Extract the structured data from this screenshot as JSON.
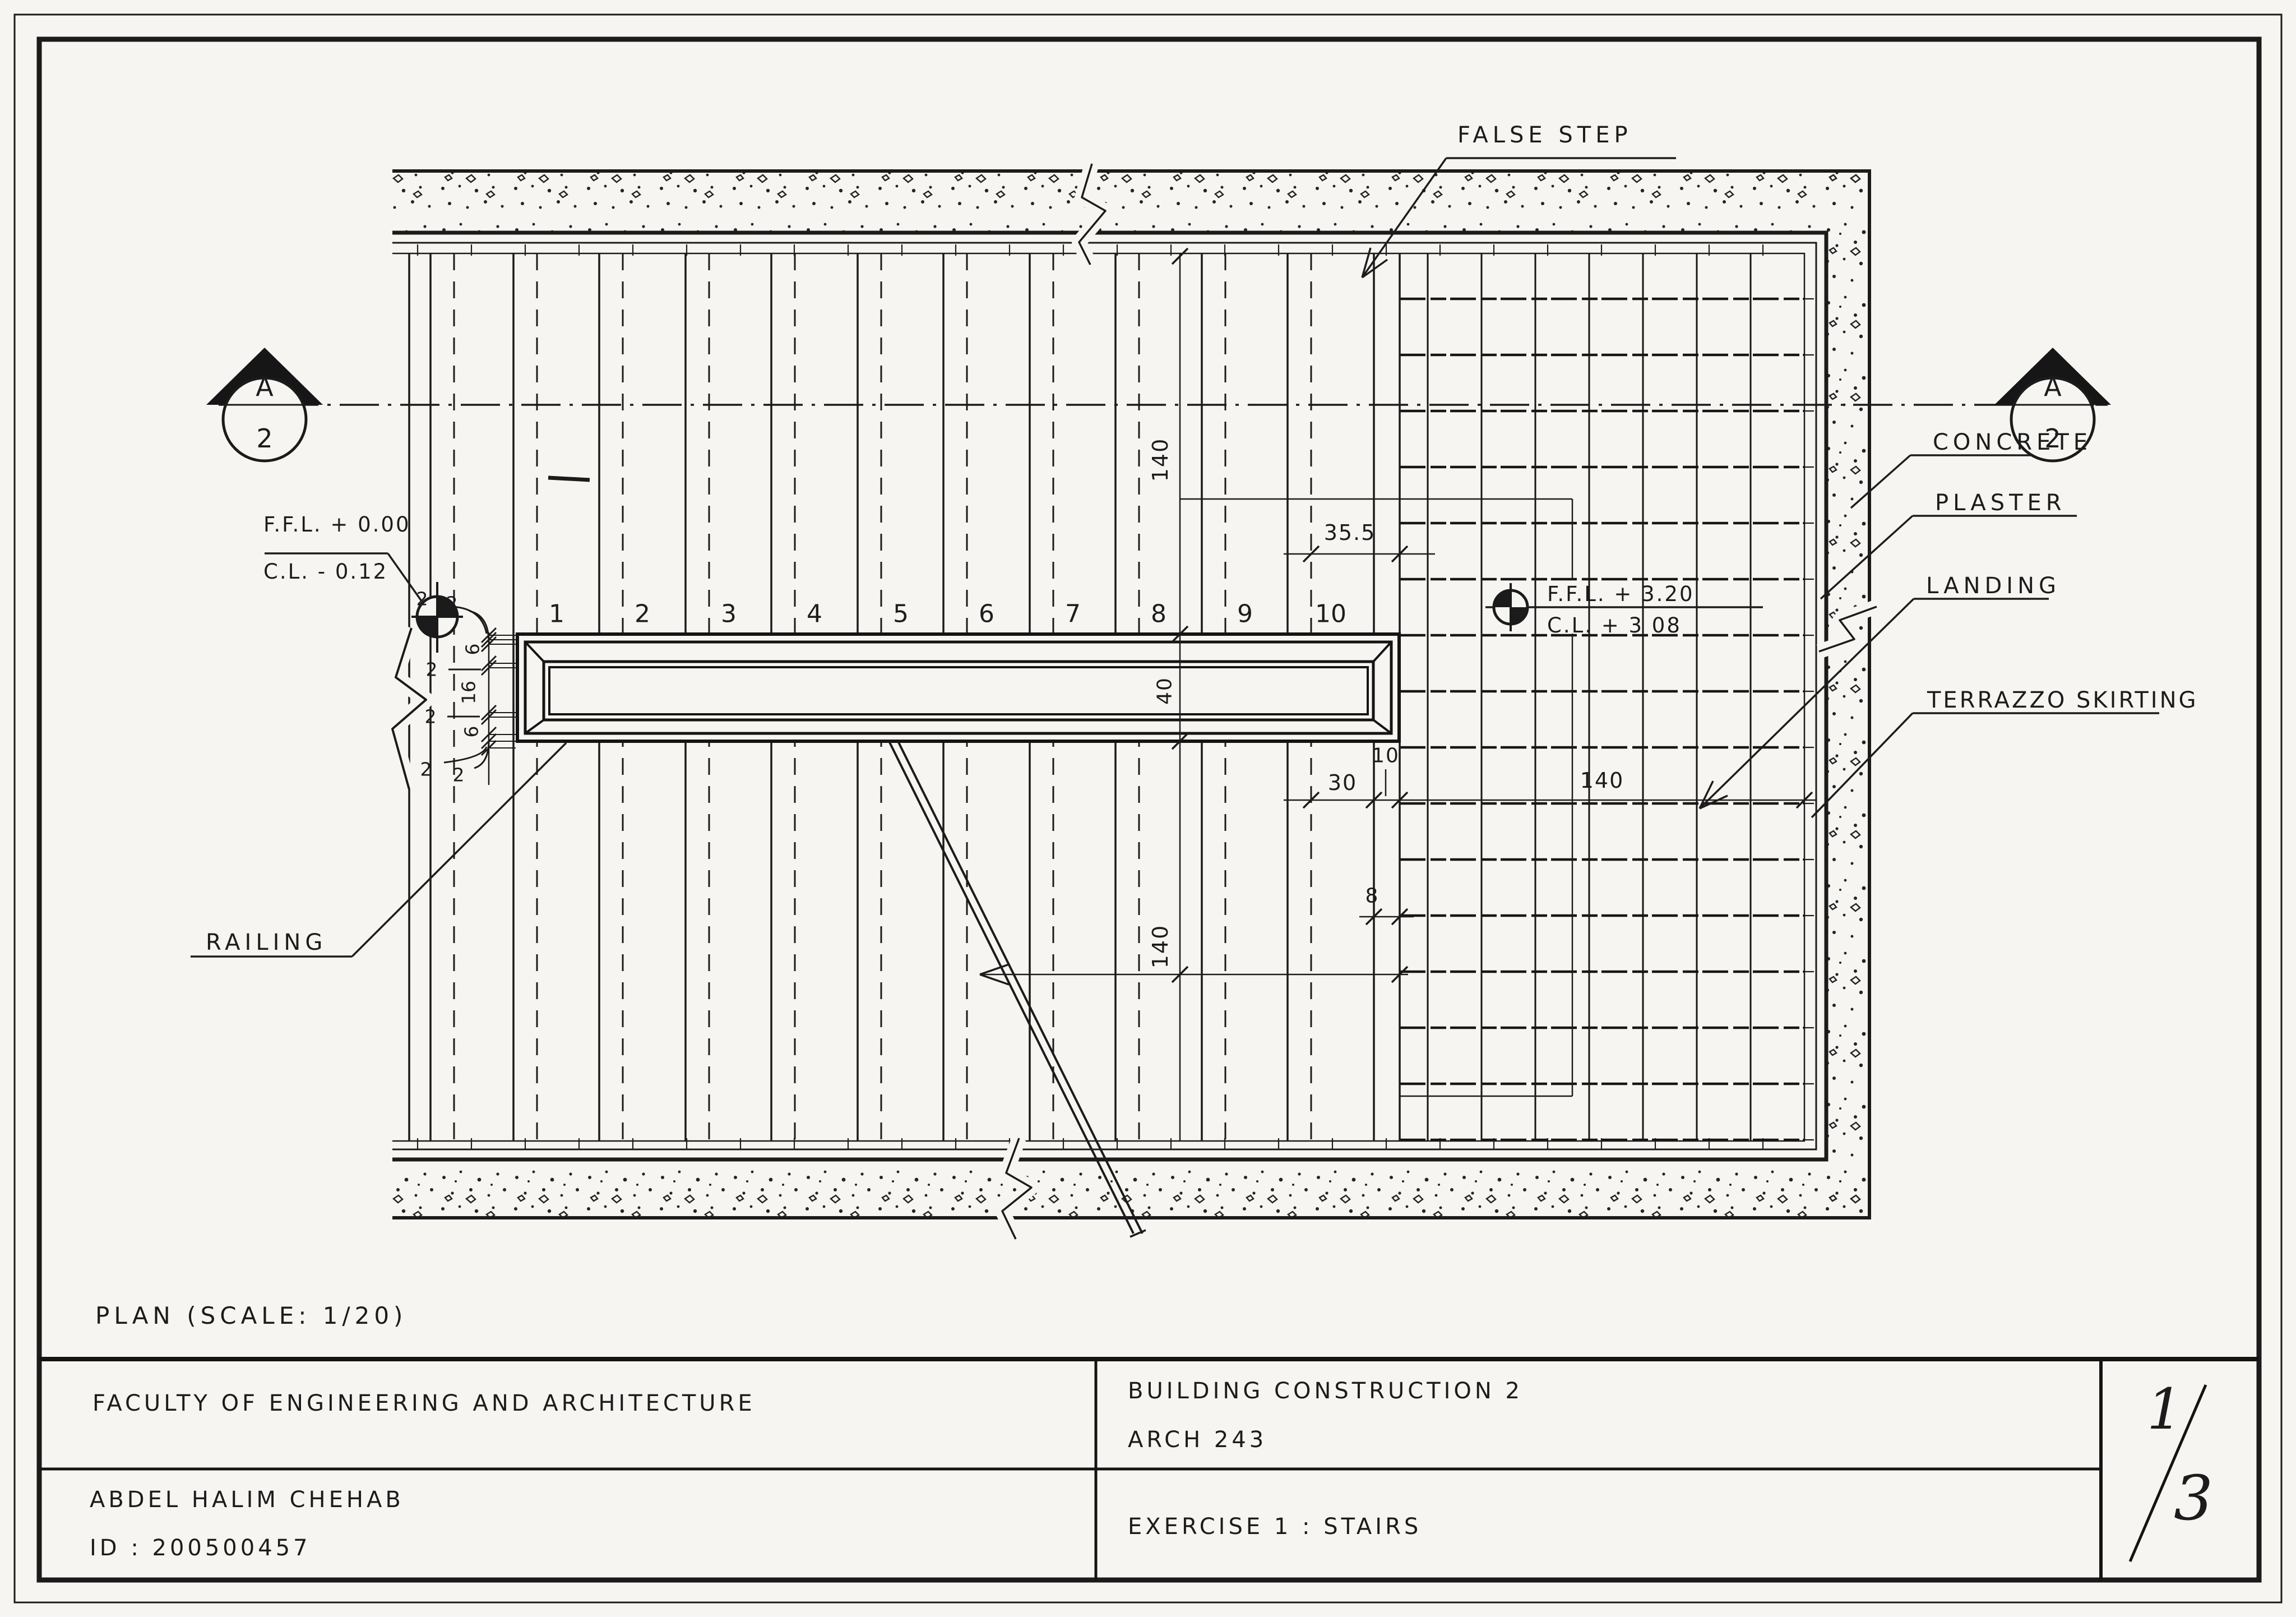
{
  "plan_title": "PLAN   (SCALE: 1/20)",
  "title_block": {
    "faculty": "FACULTY  OF  ENGINEERING  AND  ARCHITECTURE",
    "author": "ABDEL HALIM  CHEHAB",
    "student_id": "ID :  200500457",
    "course_title": "BUILDING  CONSTRUCTION  2",
    "course_code": "ARCH  243",
    "exercise_title": "EXERCISE 1 :  STAIRS",
    "sheet_number": "1",
    "sheet_total": "3"
  },
  "annotations": {
    "false_step": "FALSE STEP",
    "concrete": "CONCRETE",
    "plaster": "PLASTER",
    "landing": "LANDING",
    "terrazzo_skirting": "TERRAZZO SKIRTING",
    "railing": "RAILING"
  },
  "section_marker": {
    "letter": "A",
    "sheet": "2"
  },
  "levels": {
    "ground": {
      "ffl": "F.F.L. + 0.00",
      "cl": "C.L.  - 0.12"
    },
    "upper": {
      "ffl": "F.F.L.  + 3.20",
      "cl": "C.L.   + 3 08"
    }
  },
  "dimensions": {
    "flight_length_upper": "140",
    "false_step_width": "35.5",
    "tread_going": "30",
    "landing_strip": "10",
    "landing_width": "140",
    "skirting_width": "8",
    "flight_length_lower": "140",
    "well_width": "40",
    "railing_chain": [
      "2",
      "2",
      "6",
      "2",
      "16",
      "2",
      "6",
      "2",
      "2"
    ]
  },
  "step_numbers": [
    "1",
    "2",
    "3",
    "4",
    "5",
    "6",
    "7",
    "8",
    "9",
    "10"
  ]
}
